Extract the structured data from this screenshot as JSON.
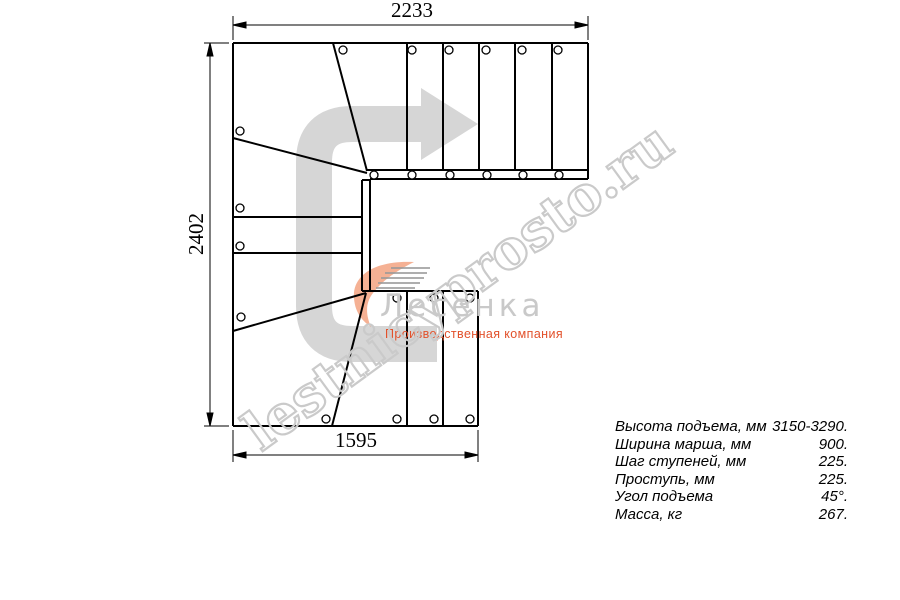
{
  "drawing": {
    "type": "staircase-plan-top-view",
    "description": "Plan drawing of a G-shaped (two 90-degree winder turns) staircase with direction-of-travel arrow",
    "line_color": "#000000",
    "arrow_color": "#d6d6d6",
    "dimensions_mm": {
      "top_width": "2233",
      "left_height": "2402",
      "bottom_width": "1595"
    }
  },
  "watermark": {
    "text": "lestnicyprosto.ru",
    "color": "#cacaca"
  },
  "logo": {
    "name": "Лесенка",
    "subtitle": "Производственная компания",
    "name_color": "#c9c9c9",
    "subtitle_color": "#e2512b",
    "icon": "stairs-swoosh-icon",
    "icon_color": "#f0875a"
  },
  "specs": {
    "rows": [
      {
        "label": "Высота подъема, мм",
        "value": "3150-3290."
      },
      {
        "label": "Ширина марша, мм",
        "value": "900."
      },
      {
        "label": "Шаг ступеней, мм",
        "value": "225."
      },
      {
        "label": "Проступь, мм",
        "value": "225."
      },
      {
        "label": "Угол подъема",
        "value": "45°."
      },
      {
        "label": "Масса, кг",
        "value": "267."
      }
    ]
  }
}
